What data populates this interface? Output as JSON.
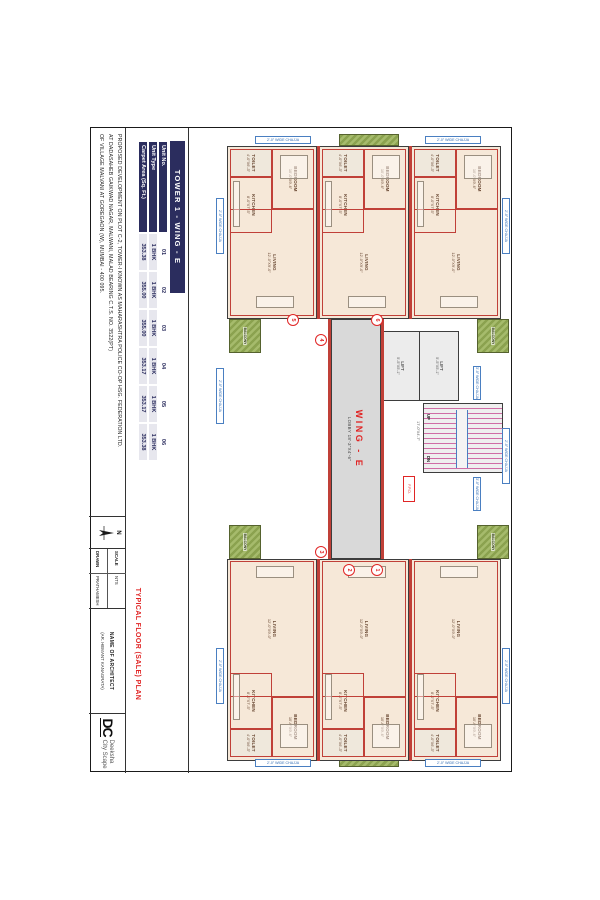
{
  "table": {
    "title": "TOWER 1 - WING - E",
    "rows": [
      {
        "label": "Unit No.",
        "values": [
          "01",
          "02",
          "03",
          "04",
          "05",
          "06"
        ]
      },
      {
        "label": "Unit Type",
        "values": [
          "1 BHK",
          "1 BHK",
          "1 BHK",
          "1 BHK",
          "1 BHK",
          "1 BHK"
        ]
      },
      {
        "label": "Carpet Area (Sq. Ft.)",
        "values": [
          "353.38",
          "355.00",
          "355.00",
          "353.17",
          "353.17",
          "353.38"
        ]
      }
    ]
  },
  "project": {
    "lines": [
      "PROPOSED DEVELOPMENT ON PLOT C-2, TOWER-I KNOWN AS MAHARASHTRA POLICE CO-OP HSG. FEDERATION LTD.",
      "AT DADASAHEB GAIKWAD NAGAR, MALWANI, MALAD BEARING C.T.S. NO. 3522(PT)",
      "OF VILLAGE MALVANI AT GOREGAON (W), MUMBAI - 400 095."
    ]
  },
  "drawing_title": "TYPICAL FLOOR (SALE) PLAN",
  "titleblock": {
    "scale_label": "SCALE",
    "scale_value": "NTS",
    "drawn_label": "DRAWN",
    "drawn_value": "PRATHAMESH",
    "architect_label": "NAME OF ARCHITECT",
    "architect_value": "(AR. HEMANT KANAGRATA)",
    "north_label": "N"
  },
  "logo": {
    "mark": "DC",
    "name_line1": "Deeksha",
    "name_line2": "City Scape"
  },
  "plan": {
    "wing_label": "WING - E",
    "lobby_label": "LOBBY",
    "lobby_dim": "18'-3\"X4'-6\"",
    "lift_label": "LIFT",
    "lift_dim": "5'-5\"X5'-1\"",
    "stair_up": "UP",
    "stair_dn": "DN",
    "fpd_label": "F.P.D.",
    "duct_label": "DUCT",
    "passage_dim": "17'-0\"X4'-7\"",
    "chajja_2": "2'-0\" WIDE CHAJJA",
    "chajja_3": "3'-0\" WIDE CHAJJA",
    "unit_numbers": [
      "1",
      "2",
      "3",
      "4",
      "5",
      "6"
    ],
    "rooms": {
      "living": {
        "name": "LIVING",
        "dim": "12'-0\"X9'-0\""
      },
      "bedroom": {
        "name": "BEDROOM",
        "dim": "10'-0\"X9'-6\""
      },
      "kitchen": {
        "name": "KITCHEN",
        "dim": "8'-0\"X7'-5\""
      },
      "toilet": {
        "name": "TOILET",
        "dim": "4'-0\"X6'-3\""
      },
      "balcony": {
        "name": "BALCONY"
      }
    },
    "colors": {
      "navy": "#2b2d5e",
      "wall_red": "#c04038",
      "title_red": "#e02525",
      "balcony_green": "#8ba24f",
      "chajja_blue": "#2f6cb5",
      "stair_pink": "#cf6da6",
      "unit_beige": "#f6e8d8",
      "core_gray": "#d9d9d9"
    }
  }
}
